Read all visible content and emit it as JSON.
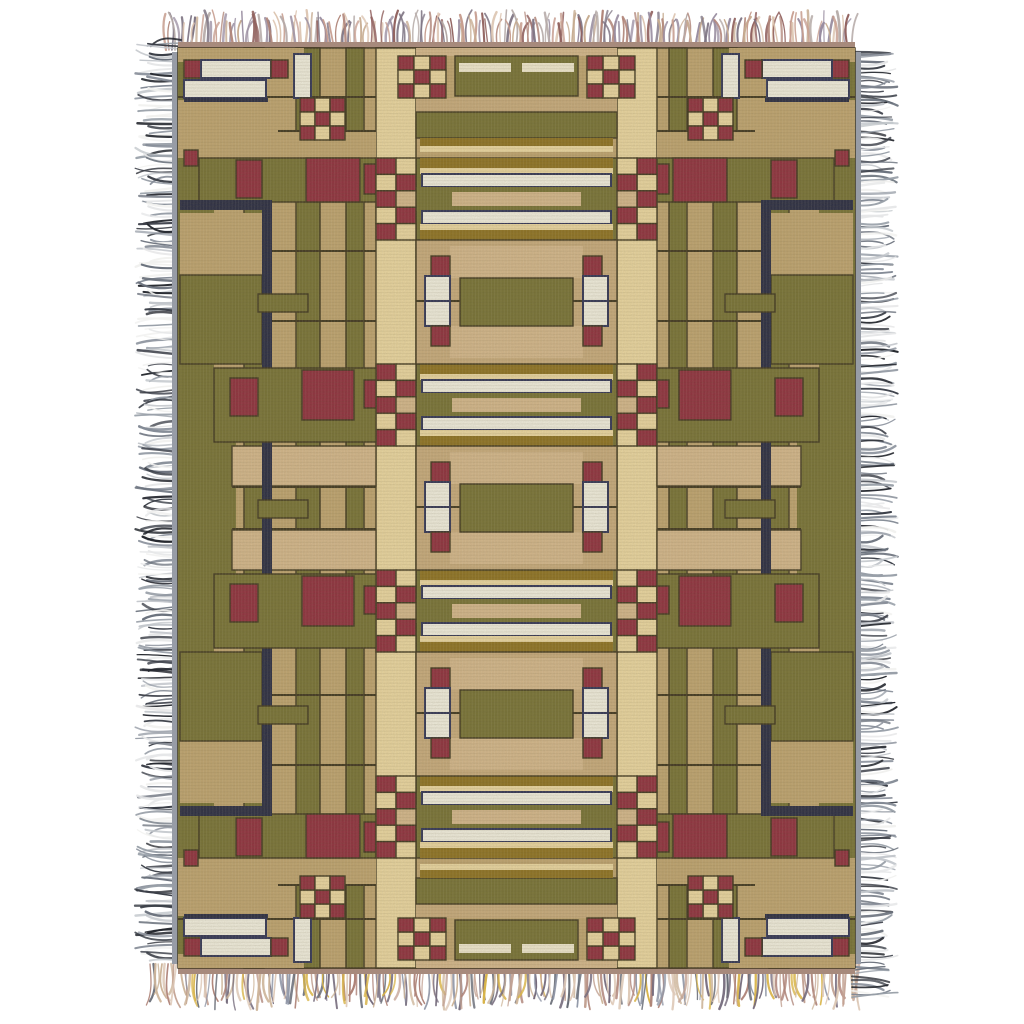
{
  "page": {
    "background": "#ffffff"
  },
  "subject": {
    "kind": "product-photo",
    "object": "woven tapestry throw blanket",
    "style": "Arts and Crafts prairie geometric pattern with multicolor fringe on all four edges"
  },
  "palette": {
    "tan": "#c0a46e",
    "tan2": "#c9ab7b",
    "camel": "#d6b88b",
    "cream": "#eed9a1",
    "pale": "#f4ecd2",
    "white": "#f5f2e3",
    "olive": "#757031",
    "olive2": "#67622c",
    "gold": "#8d701d",
    "maroon": "#8e2a3a",
    "navy": "#23263f",
    "navyline": "#2c3054",
    "line": "#3b321a",
    "bindGray": "#979ca6",
    "bindRose": "#a78a7c",
    "weaveDark": "rgba(70,58,26,0.10)",
    "weaveLight": "rgba(255,252,240,0.07)"
  },
  "fringe": {
    "left": {
      "side": "left",
      "base": 181,
      "len": [
        30,
        46
      ],
      "span": [
        40,
        962
      ],
      "step": 2.3,
      "seed": 7,
      "widths": [
        1.2,
        2.6
      ],
      "colors": [
        "#e6e7e8",
        "#c2c6cb",
        "#989fa8",
        "#6a717c",
        "#3a3e47",
        "#23262d",
        "#f1f1ef",
        "#848b96"
      ]
    },
    "right": {
      "side": "right",
      "base": 852,
      "len": [
        30,
        46
      ],
      "span": [
        52,
        1000
      ],
      "step": 2.3,
      "seed": 11,
      "widths": [
        1.2,
        2.6
      ],
      "colors": [
        "#e6e7e8",
        "#c2c6cb",
        "#989fa8",
        "#6a717c",
        "#3a3e47",
        "#23262d",
        "#f1f1ef",
        "#848b96"
      ]
    },
    "top": {
      "side": "top",
      "base": 50,
      "len": [
        26,
        40
      ],
      "span": [
        166,
        852
      ],
      "step": 2.1,
      "seed": 3,
      "widths": [
        1.2,
        2.6
      ],
      "colors": [
        "#c79e90",
        "#b08579",
        "#998da0",
        "#c6ab90",
        "#91625f",
        "#7e7483",
        "#dcc4b0",
        "#b4a9a6"
      ]
    },
    "bottom": {
      "side": "bottom",
      "base": 964,
      "len": [
        30,
        46
      ],
      "span": [
        150,
        862
      ],
      "step": 2.1,
      "seed": 5,
      "widths": [
        1.2,
        2.6
      ],
      "colors": [
        "#c2a192",
        "#9097a7",
        "#cdb59a",
        "#756b7c",
        "#ae8378",
        "#ddc8b6",
        "#666a74",
        "#d8b44a"
      ]
    }
  },
  "pattern": {
    "canvas": {
      "w": 1024,
      "h": 1024
    },
    "blanket": {
      "x": 178,
      "y": 48,
      "w": 677,
      "h": 920
    },
    "mirror_x_sum": 1033,
    "mirror_y_sum": 1016,
    "bindings": [
      [
        172,
        52,
        8,
        912,
        "bindGray",
        ""
      ],
      [
        853,
        52,
        8,
        912,
        "bindGray",
        ""
      ],
      [
        178,
        42,
        677,
        8,
        "bindRose",
        ""
      ],
      [
        178,
        966,
        677,
        8,
        "bindRose",
        ""
      ]
    ],
    "base_rects": [
      [
        178,
        48,
        677,
        920,
        "tan",
        "",
        "line"
      ],
      [
        178,
        48,
        36,
        920,
        "olive",
        "x"
      ],
      [
        244,
        48,
        20,
        920,
        "olive",
        "x",
        "line"
      ],
      [
        296,
        48,
        24,
        920,
        "olive",
        "x",
        "line"
      ],
      [
        346,
        48,
        18,
        920,
        "olive",
        "x",
        "line"
      ],
      [
        376,
        48,
        40,
        920,
        "cream",
        "x",
        "line"
      ],
      [
        178,
        132,
        198,
        26,
        "tan",
        "xy"
      ],
      [
        199,
        158,
        177,
        44,
        "olive",
        "xy",
        "line"
      ],
      [
        180,
        213,
        82,
        62,
        "tan",
        "xy"
      ],
      [
        180,
        275,
        82,
        89,
        "olive",
        "xy",
        "line"
      ],
      [
        178,
        420,
        58,
        176,
        "olive",
        "x"
      ],
      [
        232,
        446,
        144,
        40,
        "camel",
        "xy",
        "line"
      ],
      [
        232,
        486,
        144,
        2,
        "line",
        "xy"
      ],
      [
        272,
        250,
        104,
        2,
        "line",
        "xy"
      ],
      [
        272,
        320,
        104,
        2,
        "line",
        "xy"
      ],
      [
        178,
        96,
        198,
        2,
        "line",
        "xy"
      ],
      [
        178,
        130,
        198,
        2,
        "line",
        "xy"
      ],
      [
        262,
        200,
        10,
        616,
        "navy",
        "x"
      ],
      [
        180,
        200,
        92,
        10,
        "navy",
        "xy"
      ],
      [
        184,
        150,
        14,
        16,
        "maroon",
        "xy",
        "line"
      ],
      [
        236,
        160,
        26,
        38,
        "maroon",
        "xy",
        "line"
      ],
      [
        306,
        158,
        54,
        44,
        "maroon",
        "xy",
        "line"
      ],
      [
        364,
        164,
        12,
        30,
        "maroon",
        "xy",
        "line"
      ],
      [
        416,
        48,
        201,
        8,
        "camel",
        "y"
      ],
      [
        455,
        56,
        123,
        40,
        "olive",
        "y",
        "line"
      ],
      [
        522,
        63,
        52,
        9,
        "pale",
        "xy"
      ],
      [
        416,
        98,
        201,
        14,
        "tan2",
        "y"
      ],
      [
        416,
        112,
        201,
        26,
        "olive",
        "y",
        "line"
      ],
      [
        420,
        138,
        193,
        8,
        "gold",
        "y"
      ],
      [
        420,
        146,
        193,
        6,
        "cream",
        "y"
      ]
    ],
    "bands": [
      {
        "y": 158,
        "inner": false
      },
      {
        "y": 364,
        "inner": true
      },
      {
        "y": 570,
        "inner": true
      },
      {
        "y": 776,
        "inner": false
      }
    ],
    "band_center": [
      [
        416,
        0,
        201,
        82,
        "olive",
        "",
        "line"
      ],
      [
        420,
        0,
        193,
        10,
        "gold",
        ""
      ],
      [
        420,
        10,
        193,
        6,
        "cream",
        ""
      ],
      [
        422,
        16,
        189,
        13,
        "white",
        "",
        "navyline"
      ],
      [
        416,
        29,
        201,
        24,
        "olive",
        ""
      ],
      [
        452,
        34,
        129,
        14,
        "camel",
        ""
      ],
      [
        422,
        53,
        189,
        13,
        "white",
        "",
        "navyline"
      ],
      [
        420,
        66,
        193,
        6,
        "cream",
        ""
      ],
      [
        420,
        72,
        193,
        10,
        "gold",
        ""
      ]
    ],
    "band_checker": [
      [
        376,
        0,
        20,
        16.4,
        "maroon",
        "x",
        "line"
      ],
      [
        396,
        0,
        20,
        16.4,
        "cream",
        "x",
        "line"
      ],
      [
        376,
        16.4,
        20,
        16.4,
        "cream",
        "x",
        "line"
      ],
      [
        396,
        16.4,
        20,
        16.4,
        "maroon",
        "x",
        "line"
      ],
      [
        376,
        32.8,
        20,
        16.4,
        "maroon",
        "x",
        "line"
      ],
      [
        396,
        32.8,
        20,
        16.4,
        "camel",
        "x",
        "line"
      ],
      [
        376,
        49.2,
        20,
        16.4,
        "cream",
        "x",
        "line"
      ],
      [
        396,
        49.2,
        20,
        16.4,
        "maroon",
        "x",
        "line"
      ],
      [
        376,
        65.6,
        20,
        16.4,
        "maroon",
        "x",
        "line"
      ],
      [
        396,
        65.6,
        20,
        16.4,
        "cream",
        "x",
        "line"
      ]
    ],
    "band_side_inner": [
      [
        214,
        4,
        162,
        74,
        "olive",
        "x",
        "line"
      ],
      [
        230,
        14,
        28,
        38,
        "maroon",
        "x",
        "line"
      ],
      [
        302,
        6,
        52,
        50,
        "maroon",
        "x",
        "line"
      ],
      [
        364,
        16,
        12,
        28,
        "maroon",
        "x",
        "line"
      ]
    ],
    "panels": [
      240,
      446,
      652
    ],
    "panel_rects": [
      [
        416,
        0,
        201,
        124,
        "tan2",
        "",
        "line"
      ],
      [
        450,
        6,
        133,
        32,
        "camel",
        ""
      ],
      [
        450,
        86,
        133,
        32,
        "camel",
        ""
      ],
      [
        460,
        38,
        113,
        48,
        "olive",
        "",
        "line"
      ],
      [
        416,
        60,
        44,
        2,
        "line",
        "x"
      ],
      [
        258,
        54,
        50,
        18,
        "olive",
        "x",
        "line"
      ],
      [
        431,
        16,
        19,
        20,
        "maroon",
        "x",
        "line"
      ],
      [
        425,
        36,
        25,
        25,
        "white",
        "x",
        "navyline"
      ],
      [
        425,
        61,
        25,
        25,
        "white",
        "x",
        "navyline"
      ],
      [
        431,
        86,
        19,
        20,
        "maroon",
        "x",
        "line"
      ]
    ],
    "accent_rects": [
      [
        178,
        48,
        126,
        14,
        "tan",
        "xy"
      ],
      [
        178,
        100,
        100,
        32,
        "tan",
        "xy"
      ],
      [
        184,
        60,
        17,
        18,
        "maroon",
        "xy",
        "line"
      ],
      [
        201,
        60,
        70,
        18,
        "white",
        "xy",
        "navyline"
      ],
      [
        271,
        60,
        17,
        18,
        "maroon",
        "xy",
        "line"
      ],
      [
        184,
        80,
        82,
        18,
        "white",
        "xy",
        "navyline"
      ],
      [
        184,
        98,
        84,
        4,
        "navy",
        "xy"
      ],
      [
        294,
        54,
        17,
        44,
        "white",
        "xy",
        "navyline"
      ],
      [
        300,
        98,
        15,
        14,
        "maroon",
        "xy",
        "line"
      ],
      [
        315,
        98,
        15,
        14,
        "cream",
        "xy",
        "line"
      ],
      [
        330,
        98,
        15,
        14,
        "maroon",
        "xy",
        "line"
      ],
      [
        300,
        112,
        15,
        14,
        "cream",
        "xy",
        "line"
      ],
      [
        315,
        112,
        15,
        14,
        "maroon",
        "xy",
        "line"
      ],
      [
        330,
        112,
        15,
        14,
        "cream",
        "xy",
        "line"
      ],
      [
        300,
        126,
        15,
        14,
        "maroon",
        "xy",
        "line"
      ],
      [
        315,
        126,
        15,
        14,
        "cream",
        "xy",
        "line"
      ],
      [
        330,
        126,
        15,
        14,
        "maroon",
        "xy",
        "line"
      ],
      [
        398,
        56,
        16,
        14,
        "maroon",
        "xy",
        "line"
      ],
      [
        414,
        56,
        16,
        14,
        "cream",
        "xy",
        "line"
      ],
      [
        430,
        56,
        16,
        14,
        "maroon",
        "xy",
        "line"
      ],
      [
        398,
        70,
        16,
        14,
        "cream",
        "xy",
        "line"
      ],
      [
        414,
        70,
        16,
        14,
        "maroon",
        "xy",
        "line"
      ],
      [
        430,
        70,
        16,
        14,
        "cream",
        "xy",
        "line"
      ],
      [
        398,
        84,
        16,
        14,
        "maroon",
        "xy",
        "line"
      ],
      [
        414,
        84,
        16,
        14,
        "cream",
        "xy",
        "line"
      ],
      [
        430,
        84,
        16,
        14,
        "maroon",
        "xy",
        "line"
      ]
    ]
  }
}
